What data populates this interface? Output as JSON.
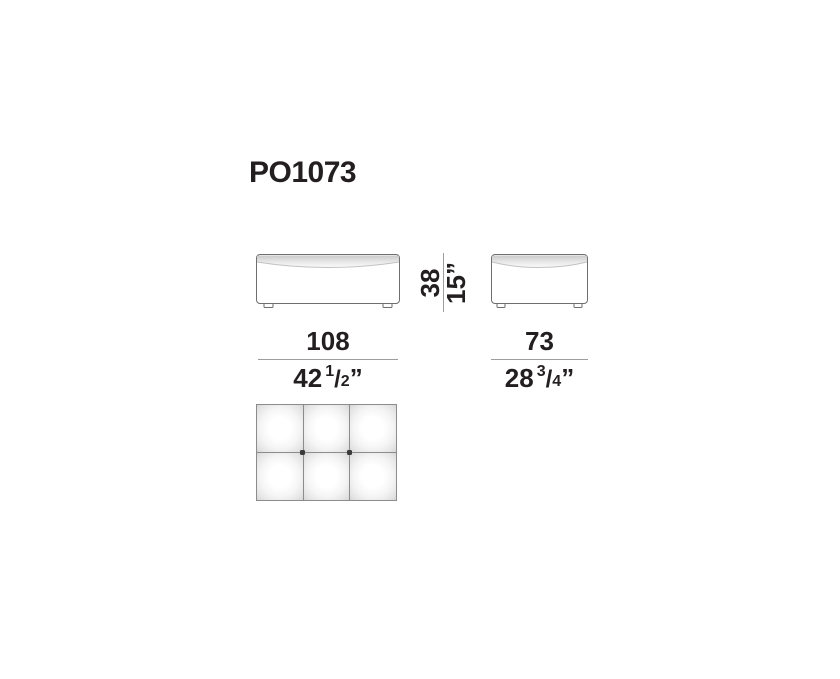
{
  "title": "PO1073",
  "drawing": {
    "front_view": "front elevation of pouf",
    "side_view": "side elevation of pouf",
    "top_view": "top view of pouf with 6 tufted cushions and 2 buttons"
  },
  "dimensions": {
    "height": {
      "cm": "38",
      "inches": "15”"
    },
    "width": {
      "cm": "108",
      "inches_whole": "42",
      "fraction_numerator": "1",
      "fraction_denominator": "2",
      "unit_mark": "”"
    },
    "depth": {
      "cm": "73",
      "inches_whole": "28",
      "fraction_numerator": "3",
      "fraction_denominator": "4",
      "unit_mark": "”"
    }
  },
  "colors": {
    "text": "#231f20",
    "dimension_line": "#9d9d9d",
    "outline": "#6e6e6e",
    "grid_line": "#8c8c8c",
    "button_dot": "#3a3a3a",
    "cushion_edge": "#cbcbcb",
    "background": "#ffffff"
  }
}
